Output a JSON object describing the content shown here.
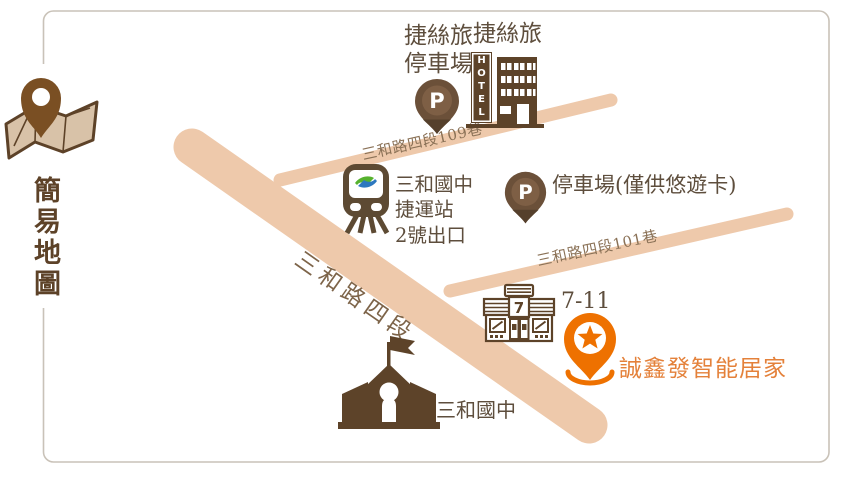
{
  "legend": {
    "title": "簡易地圖"
  },
  "roads": {
    "main": {
      "label": "三和路四段"
    },
    "lane109": {
      "label": "三和路四段109巷"
    },
    "lane101": {
      "label": "三和路四段101巷"
    }
  },
  "pois": {
    "justsleep_hotel": {
      "label": "捷絲旅",
      "sign": "HOTEL"
    },
    "justsleep_parking": {
      "label_line1": "捷絲旅",
      "label_line2": "停車場",
      "pin_letter": "P"
    },
    "metro": {
      "label_line1": "三和國中",
      "label_line2": "捷運站",
      "label_line3": "2號出口"
    },
    "easycard_parking": {
      "label": "停車場(僅供悠遊卡)",
      "pin_letter": "P"
    },
    "seven_eleven": {
      "label": "7-11",
      "sign": "7"
    },
    "destination": {
      "label": "誠鑫發智能居家"
    },
    "school": {
      "label": "三和國中"
    }
  },
  "colors": {
    "icon_brown": "#5d4329",
    "text_brown": "#5e4e3d",
    "road_tan": "#eec9ab",
    "road_label_brown": "#8a7156",
    "pin_brown": "#6b5039",
    "pin_orange": "#ee7100",
    "orange_text": "#e4813a",
    "metro_green": "#56b22e",
    "metro_blue": "#2d78bf",
    "border_gray": "#c9c2b8"
  }
}
